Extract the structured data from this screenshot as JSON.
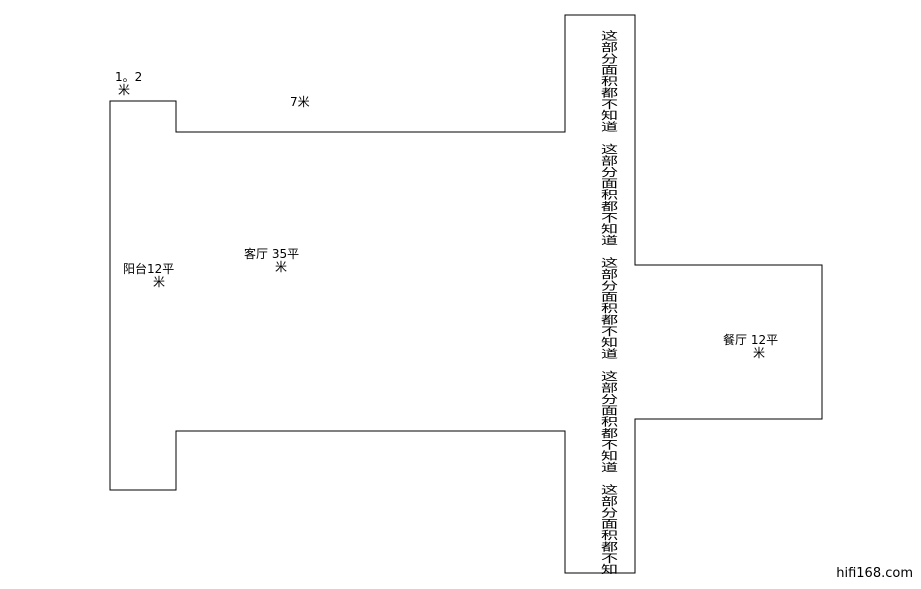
{
  "page": {
    "width": 921,
    "height": 589,
    "background_color": "#ffffff",
    "line_color": "#000000",
    "text_color": "#000000"
  },
  "floorplan": {
    "outline_points": "110,101 176,101 176,132 565,132 565,15 635,15 635,265 822,265 822,419 635,419 635,573 565,573 565,431 176,431 176,490 110,490",
    "labels": {
      "notch_width": {
        "line1": "1。2",
        "line2": "米"
      },
      "top_width": {
        "text": "7米"
      },
      "balcony": {
        "line1": "阳台12平",
        "line2": "米"
      },
      "living": {
        "line1": "客厅 35平",
        "line2": "米"
      },
      "dining": {
        "line1": "餐厅 12平",
        "line2": "米"
      }
    },
    "corridor_note": {
      "text": "这部分面积都不知道　这部分面积都不知道　这部分面积都不知道　这部分面积都不知道　这部分面积都不知"
    }
  },
  "watermark": {
    "text": "hifi168.com"
  }
}
